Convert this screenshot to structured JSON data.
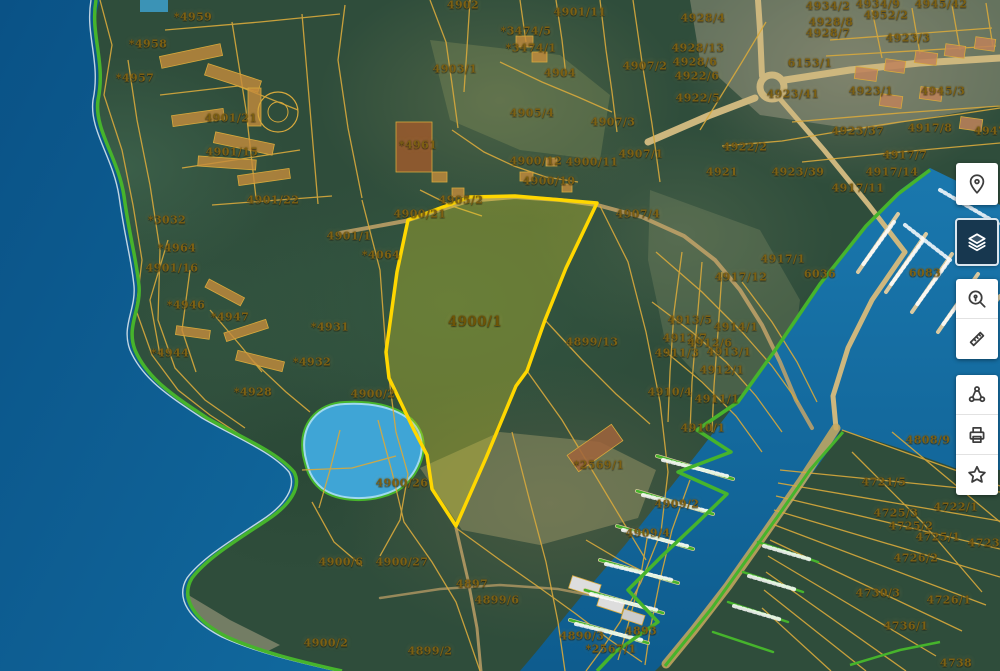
{
  "app": {
    "name": "Cadastral map viewer"
  },
  "toolbar": {
    "buttons": [
      {
        "name": "location-pin",
        "selected": false
      },
      {
        "name": "layers",
        "selected": true
      },
      {
        "name": "search-location",
        "selected": false
      },
      {
        "name": "measure",
        "selected": false
      },
      {
        "name": "share",
        "selected": false
      },
      {
        "name": "print",
        "selected": false
      },
      {
        "name": "favorites",
        "selected": false
      }
    ]
  },
  "map": {
    "colors": {
      "highlight_outline": "#ffd700",
      "highlight_fill": "rgba(222,210,40,0.32)",
      "cadastral_line": "#d8a93c",
      "coast_green": "#46b42c",
      "sea": "#0d5f95",
      "pond": "#3fa5d6",
      "label": "#7d6012"
    },
    "highlighted_parcel": {
      "id": "4900/1",
      "points": [
        [
          408,
          220
        ],
        [
          470,
          197
        ],
        [
          515,
          196
        ],
        [
          597,
          203
        ],
        [
          566,
          268
        ],
        [
          545,
          320
        ],
        [
          527,
          371
        ],
        [
          516,
          386
        ],
        [
          486,
          458
        ],
        [
          456,
          526
        ],
        [
          432,
          489
        ],
        [
          427,
          455
        ],
        [
          414,
          430
        ],
        [
          389,
          378
        ],
        [
          386,
          352
        ],
        [
          397,
          272
        ]
      ]
    },
    "labels": [
      {
        "text": "*4959",
        "x": 193,
        "y": 17
      },
      {
        "text": "*4958",
        "x": 148,
        "y": 44
      },
      {
        "text": "*4957",
        "x": 135,
        "y": 78
      },
      {
        "text": "4901/21",
        "x": 231,
        "y": 118
      },
      {
        "text": "4901/15",
        "x": 232,
        "y": 152
      },
      {
        "text": "4901/22",
        "x": 273,
        "y": 200
      },
      {
        "text": "*3032",
        "x": 167,
        "y": 220
      },
      {
        "text": "*4964",
        "x": 177,
        "y": 248
      },
      {
        "text": "4901/16",
        "x": 172,
        "y": 268
      },
      {
        "text": "*4946",
        "x": 186,
        "y": 305
      },
      {
        "text": "*4947",
        "x": 230,
        "y": 317
      },
      {
        "text": "*4944",
        "x": 170,
        "y": 353
      },
      {
        "text": "*4931",
        "x": 330,
        "y": 327
      },
      {
        "text": "*4932",
        "x": 312,
        "y": 362
      },
      {
        "text": "*4928",
        "x": 253,
        "y": 392
      },
      {
        "text": "4900/2",
        "x": 373,
        "y": 394
      },
      {
        "text": "4901/1",
        "x": 349,
        "y": 236
      },
      {
        "text": "*4064",
        "x": 381,
        "y": 255
      },
      {
        "text": "4902",
        "x": 463,
        "y": 5
      },
      {
        "text": "4901/11",
        "x": 580,
        "y": 12
      },
      {
        "text": "*3474/5",
        "x": 526,
        "y": 31
      },
      {
        "text": "*3474/1",
        "x": 531,
        "y": 48
      },
      {
        "text": "4903/1",
        "x": 455,
        "y": 69
      },
      {
        "text": "4904",
        "x": 560,
        "y": 73
      },
      {
        "text": "4905/4",
        "x": 532,
        "y": 113
      },
      {
        "text": "*4961",
        "x": 418,
        "y": 145
      },
      {
        "text": "4900/12",
        "x": 536,
        "y": 161
      },
      {
        "text": "4900/11",
        "x": 592,
        "y": 162
      },
      {
        "text": "4900/10",
        "x": 549,
        "y": 181
      },
      {
        "text": "4905/2",
        "x": 461,
        "y": 200
      },
      {
        "text": "4900/21",
        "x": 420,
        "y": 214
      },
      {
        "text": "4907/2",
        "x": 645,
        "y": 66
      },
      {
        "text": "4907/3",
        "x": 613,
        "y": 122
      },
      {
        "text": "4907/1",
        "x": 641,
        "y": 154
      },
      {
        "text": "4907/4",
        "x": 638,
        "y": 214
      },
      {
        "text": "4900/1",
        "x": 475,
        "y": 322,
        "big": true
      },
      {
        "text": "4899/13",
        "x": 592,
        "y": 342
      },
      {
        "text": "4928/4",
        "x": 703,
        "y": 18
      },
      {
        "text": "4928/13",
        "x": 698,
        "y": 48
      },
      {
        "text": "4928/6",
        "x": 695,
        "y": 62
      },
      {
        "text": "4922/6",
        "x": 697,
        "y": 76
      },
      {
        "text": "4922/5",
        "x": 698,
        "y": 98
      },
      {
        "text": "6153/1",
        "x": 810,
        "y": 63
      },
      {
        "text": "4923/41",
        "x": 793,
        "y": 94
      },
      {
        "text": "4923/1",
        "x": 871,
        "y": 91
      },
      {
        "text": "4945/3",
        "x": 943,
        "y": 91
      },
      {
        "text": "4923/37",
        "x": 858,
        "y": 131
      },
      {
        "text": "4917/8",
        "x": 930,
        "y": 128
      },
      {
        "text": "4947",
        "x": 990,
        "y": 131
      },
      {
        "text": "4917/7",
        "x": 905,
        "y": 155
      },
      {
        "text": "4921",
        "x": 722,
        "y": 172
      },
      {
        "text": "4923/39",
        "x": 798,
        "y": 172
      },
      {
        "text": "4917/14",
        "x": 892,
        "y": 172
      },
      {
        "text": "4917/11",
        "x": 858,
        "y": 188
      },
      {
        "text": "4934/2",
        "x": 828,
        "y": 6
      },
      {
        "text": "4934/9",
        "x": 878,
        "y": 4
      },
      {
        "text": "4952/2",
        "x": 886,
        "y": 15
      },
      {
        "text": "4945/42",
        "x": 941,
        "y": 4
      },
      {
        "text": "4928/8",
        "x": 831,
        "y": 22
      },
      {
        "text": "4928/7",
        "x": 828,
        "y": 33
      },
      {
        "text": "4923/3",
        "x": 908,
        "y": 38
      },
      {
        "text": "4922/2",
        "x": 745,
        "y": 147
      },
      {
        "text": "4917/1",
        "x": 783,
        "y": 259
      },
      {
        "text": "4917/12",
        "x": 741,
        "y": 277
      },
      {
        "text": "6036",
        "x": 820,
        "y": 274
      },
      {
        "text": "6083",
        "x": 925,
        "y": 273
      },
      {
        "text": "4913/5",
        "x": 690,
        "y": 320
      },
      {
        "text": "4914/1",
        "x": 736,
        "y": 327
      },
      {
        "text": "4912/7",
        "x": 685,
        "y": 338
      },
      {
        "text": "4912/6",
        "x": 710,
        "y": 343
      },
      {
        "text": "4911/3",
        "x": 677,
        "y": 353
      },
      {
        "text": "4913/1",
        "x": 729,
        "y": 352
      },
      {
        "text": "4912/1",
        "x": 722,
        "y": 370
      },
      {
        "text": "4910/4",
        "x": 670,
        "y": 392
      },
      {
        "text": "4911/1",
        "x": 717,
        "y": 399
      },
      {
        "text": "4910/1",
        "x": 703,
        "y": 428
      },
      {
        "text": "4909/2",
        "x": 677,
        "y": 504
      },
      {
        "text": "4909/4",
        "x": 648,
        "y": 533
      },
      {
        "text": "4808/9",
        "x": 928,
        "y": 440
      },
      {
        "text": "4721/5",
        "x": 884,
        "y": 482
      },
      {
        "text": "4722/1",
        "x": 956,
        "y": 507
      },
      {
        "text": "4725/3",
        "x": 896,
        "y": 513
      },
      {
        "text": "4725/2",
        "x": 911,
        "y": 526
      },
      {
        "text": "4725/1",
        "x": 938,
        "y": 537
      },
      {
        "text": "4723/4",
        "x": 990,
        "y": 543
      },
      {
        "text": "4726/2",
        "x": 916,
        "y": 558
      },
      {
        "text": "4730/3",
        "x": 878,
        "y": 593
      },
      {
        "text": "4726/1",
        "x": 949,
        "y": 600
      },
      {
        "text": "4736/1",
        "x": 906,
        "y": 626
      },
      {
        "text": "4738",
        "x": 956,
        "y": 663
      },
      {
        "text": "*2569/1",
        "x": 599,
        "y": 465
      },
      {
        "text": "4900/26",
        "x": 402,
        "y": 483
      },
      {
        "text": "4900/6",
        "x": 341,
        "y": 562
      },
      {
        "text": "4900/27",
        "x": 402,
        "y": 562
      },
      {
        "text": "4897",
        "x": 472,
        "y": 584
      },
      {
        "text": "4899/6",
        "x": 497,
        "y": 600
      },
      {
        "text": "4900/2",
        "x": 326,
        "y": 643
      },
      {
        "text": "4899/2",
        "x": 430,
        "y": 651
      },
      {
        "text": "4890/3",
        "x": 582,
        "y": 636
      },
      {
        "text": "*2567/1",
        "x": 611,
        "y": 649
      },
      {
        "text": "4893",
        "x": 641,
        "y": 631
      }
    ]
  }
}
